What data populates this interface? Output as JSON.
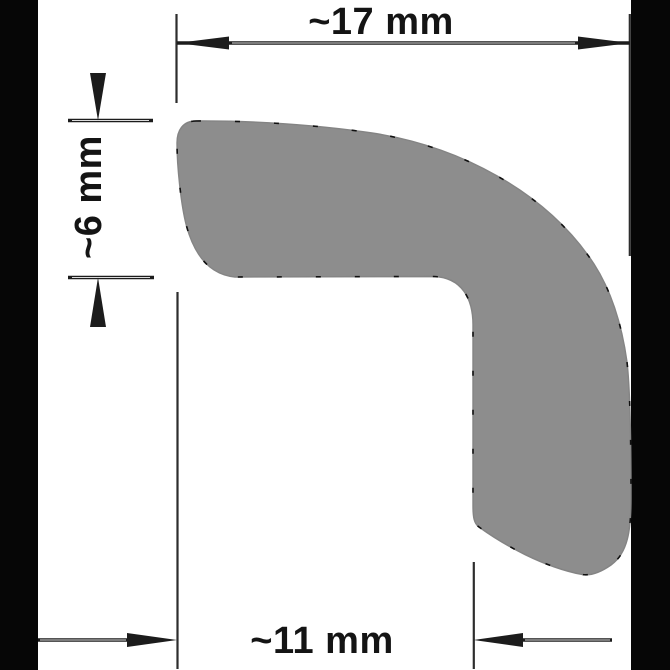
{
  "drawing": {
    "kind": "profile-cross-section",
    "colors": {
      "background": "#ffffff",
      "scan_edge": "#060606",
      "profile_fill": "#8d8d8d",
      "profile_rim": "#848484",
      "outline_artifact": "#101010",
      "ink": "#1c1c1c"
    },
    "dimensions": {
      "top_width": {
        "label": "~17 mm"
      },
      "left_height": {
        "label": "~6 mm"
      },
      "bottom_width": {
        "label": "~11 mm"
      }
    }
  }
}
